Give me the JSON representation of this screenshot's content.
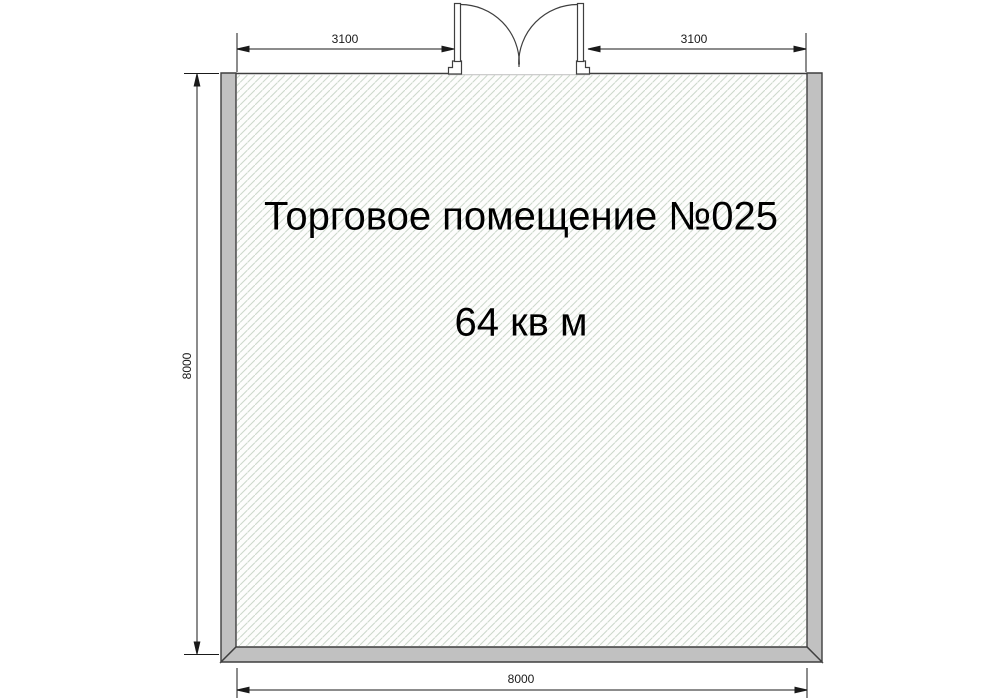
{
  "room": {
    "name_label": "Торговое помещение №025",
    "area_label": "64 кв м"
  },
  "dimensions": {
    "top_left": "3100",
    "top_right": "3100",
    "left": "8000",
    "bottom": "8000"
  },
  "colors": {
    "background": "#ffffff",
    "wall_fill": "#c1c1c1",
    "wall_outline": "#3f3f3f",
    "hatch_line": "#ccd8cb",
    "floor_fill": "#fdfdfc",
    "threshold_line": "#c6c6c6",
    "dimension_line": "#1a1a1a",
    "text": "#000000"
  }
}
